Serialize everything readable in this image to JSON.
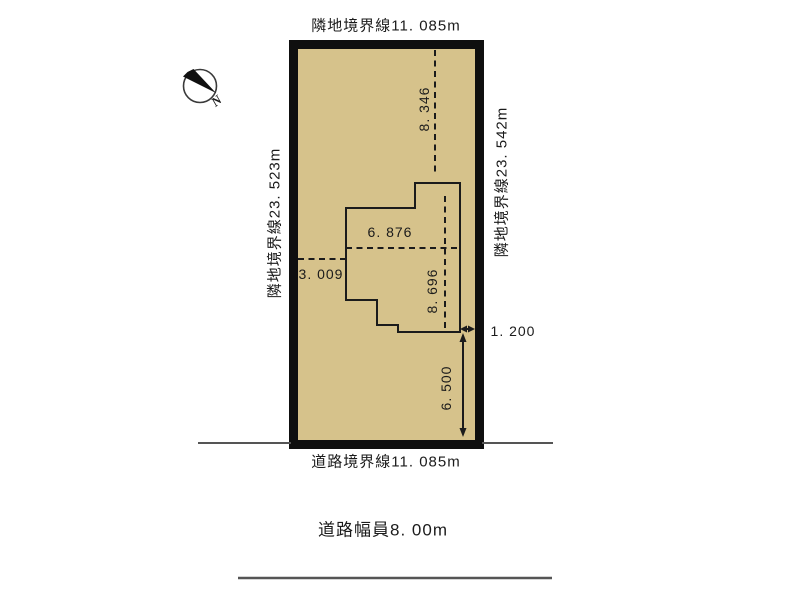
{
  "diagram": {
    "compass": {
      "label": "N"
    },
    "colors": {
      "plot_fill": "#d6c28b",
      "plot_border": "#0f0f0f",
      "line": "#1b1b1b",
      "road_line": "#555555"
    },
    "boundaries": {
      "top": "隣地境界線11. 085m",
      "left": "隣地境界線23. 523m",
      "right": "隣地境界線23. 542m",
      "road": "道路境界線11. 085m",
      "road_width": "道路幅員8. 00m"
    },
    "dimensions": {
      "upper_setback": "8. 346",
      "building_width": "6. 876",
      "left_setback": "3. 009",
      "building_depth": "8. 696",
      "right_setback": "1. 200",
      "lower_setback": "6. 500"
    }
  }
}
